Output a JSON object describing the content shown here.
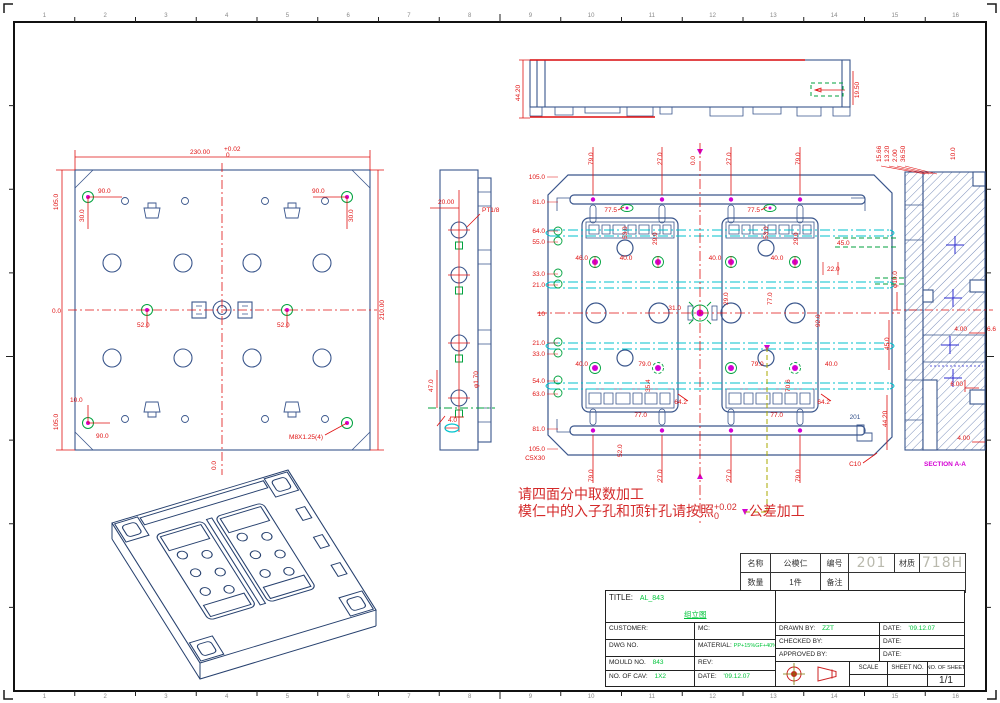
{
  "colors": {
    "line": "#3a568c",
    "dim": "#e01111",
    "green": "#00a23e",
    "cyan": "#00c2cd",
    "magenta": "#d400d4",
    "title_green": "#00c43a",
    "big_gray": "#b9b9ad"
  },
  "frame": {
    "zones": [
      "1",
      "2",
      "3",
      "4",
      "5",
      "6",
      "7",
      "8",
      "9",
      "10",
      "11",
      "12",
      "13",
      "14",
      "15",
      "16"
    ]
  },
  "annotation": {
    "line1": "请四面分中取数加工",
    "line2": "模仁中的入子孔和顶针孔请按照",
    "tol_plus": "+0.02",
    "tol_zero": "0",
    "suffix": "公差加工"
  },
  "parts_table": {
    "name_label": "名称",
    "name_value": "公模仁",
    "no_label": "编号",
    "no_value": "201",
    "mat_label": "材质",
    "mat_value": "718H",
    "qty_label": "数量",
    "qty_value": "1件",
    "remark_label": "备注",
    "remark_value": ""
  },
  "title_block": {
    "title_label": "TITLE:",
    "title_value": "AL_843",
    "subtitle": "组立图",
    "customer": "CUSTOMER:",
    "mc": "MC:",
    "dwg_no": "DWG NO.",
    "material_label": "MATERIAL:",
    "material_value": "PP+15%GF+40%MD",
    "mould_no": "MOULD NO.",
    "mould_no_value": "843",
    "rev": "REV:",
    "cav_label": "NO. OF CAV:",
    "cav_value": "1X2",
    "date_label": "DATE:",
    "date_value": "'09.12.07",
    "drawn": "DRAWN BY:",
    "drawn_value": "ZZT",
    "date1": "DATE:",
    "date1_value": "'09.12.07",
    "checked": "CHECKED BY:",
    "date2": "DATE:",
    "approved": "APPROVED BY:",
    "date3": "DATE:",
    "scale": "SCALE",
    "sheet_no": "SHEET NO.",
    "no_of_sheet": "NO. OF SHEET",
    "sheet_value": "1/1"
  },
  "plan": {
    "width": "230.00",
    "tp": "+0.02",
    "tz": "0",
    "l1": "105.0",
    "l2": "0.0",
    "l3": "105.0",
    "r1": "210.00",
    "d90a": "90.0",
    "d90b": "90.0",
    "d30a": "30.0",
    "d30b": "30.0",
    "d52a": "52.0",
    "d52b": "52.0",
    "d10": "10.0",
    "d90c": "90.0",
    "m8": "M8X1.25(4)",
    "b0": "0.0"
  },
  "side": {
    "d20": "20.00",
    "pt": "PT1/8",
    "d47": "47.0",
    "d4": "4.0",
    "phi": "φ1.70"
  },
  "main": {
    "left": [
      "105.0",
      "81.0",
      "64.0",
      "55.0",
      "33.0",
      "21.0",
      "10",
      "21.0",
      "33.0",
      "54.0",
      "63.0",
      "81.0",
      "105.0"
    ],
    "c5": "C5X30",
    "c10": "C10",
    "mark": "201",
    "top": [
      "79.0",
      "27.0",
      "0.0",
      "27.0",
      "79.0"
    ],
    "bottom": [
      "79.0",
      "27.0",
      "27.0",
      "79.0"
    ],
    "b52": "52.0",
    "i775a": "77.5",
    "i775b": "77.5",
    "i53a": "53.0",
    "i53b": "53.0",
    "i29a": "29.0",
    "i29b": "29.0",
    "i46": "46.0",
    "i40a": "40.0",
    "i40b": "40.0",
    "i40c": "40.0",
    "i29c": "29.0",
    "i77a": "77.0",
    "i92": "92.0",
    "i31": "31.0",
    "i22": "22.0",
    "i45": "45.0",
    "i40d": "40.0",
    "i79a": "79.0",
    "i79b": "79.0",
    "i40e": "40.0",
    "i354": "35.4",
    "i706": "70.6",
    "i642a": "64.2",
    "i642b": "64.2",
    "i77b": "77.0",
    "i77c": "77.0"
  },
  "topview": {
    "d442": "44.20",
    "d195": "19.50"
  },
  "section": {
    "t1": "15.66",
    "t2": "13.20",
    "t3": "2.00",
    "t4": "36.50",
    "r10": "10.0",
    "phi10": "φ10.0",
    "d45": "45.0",
    "d4a": "4.00",
    "d66": "6.6",
    "d6": "6.00",
    "d442": "44.20",
    "d4b": "4.00",
    "label": "SECTION A-A"
  }
}
